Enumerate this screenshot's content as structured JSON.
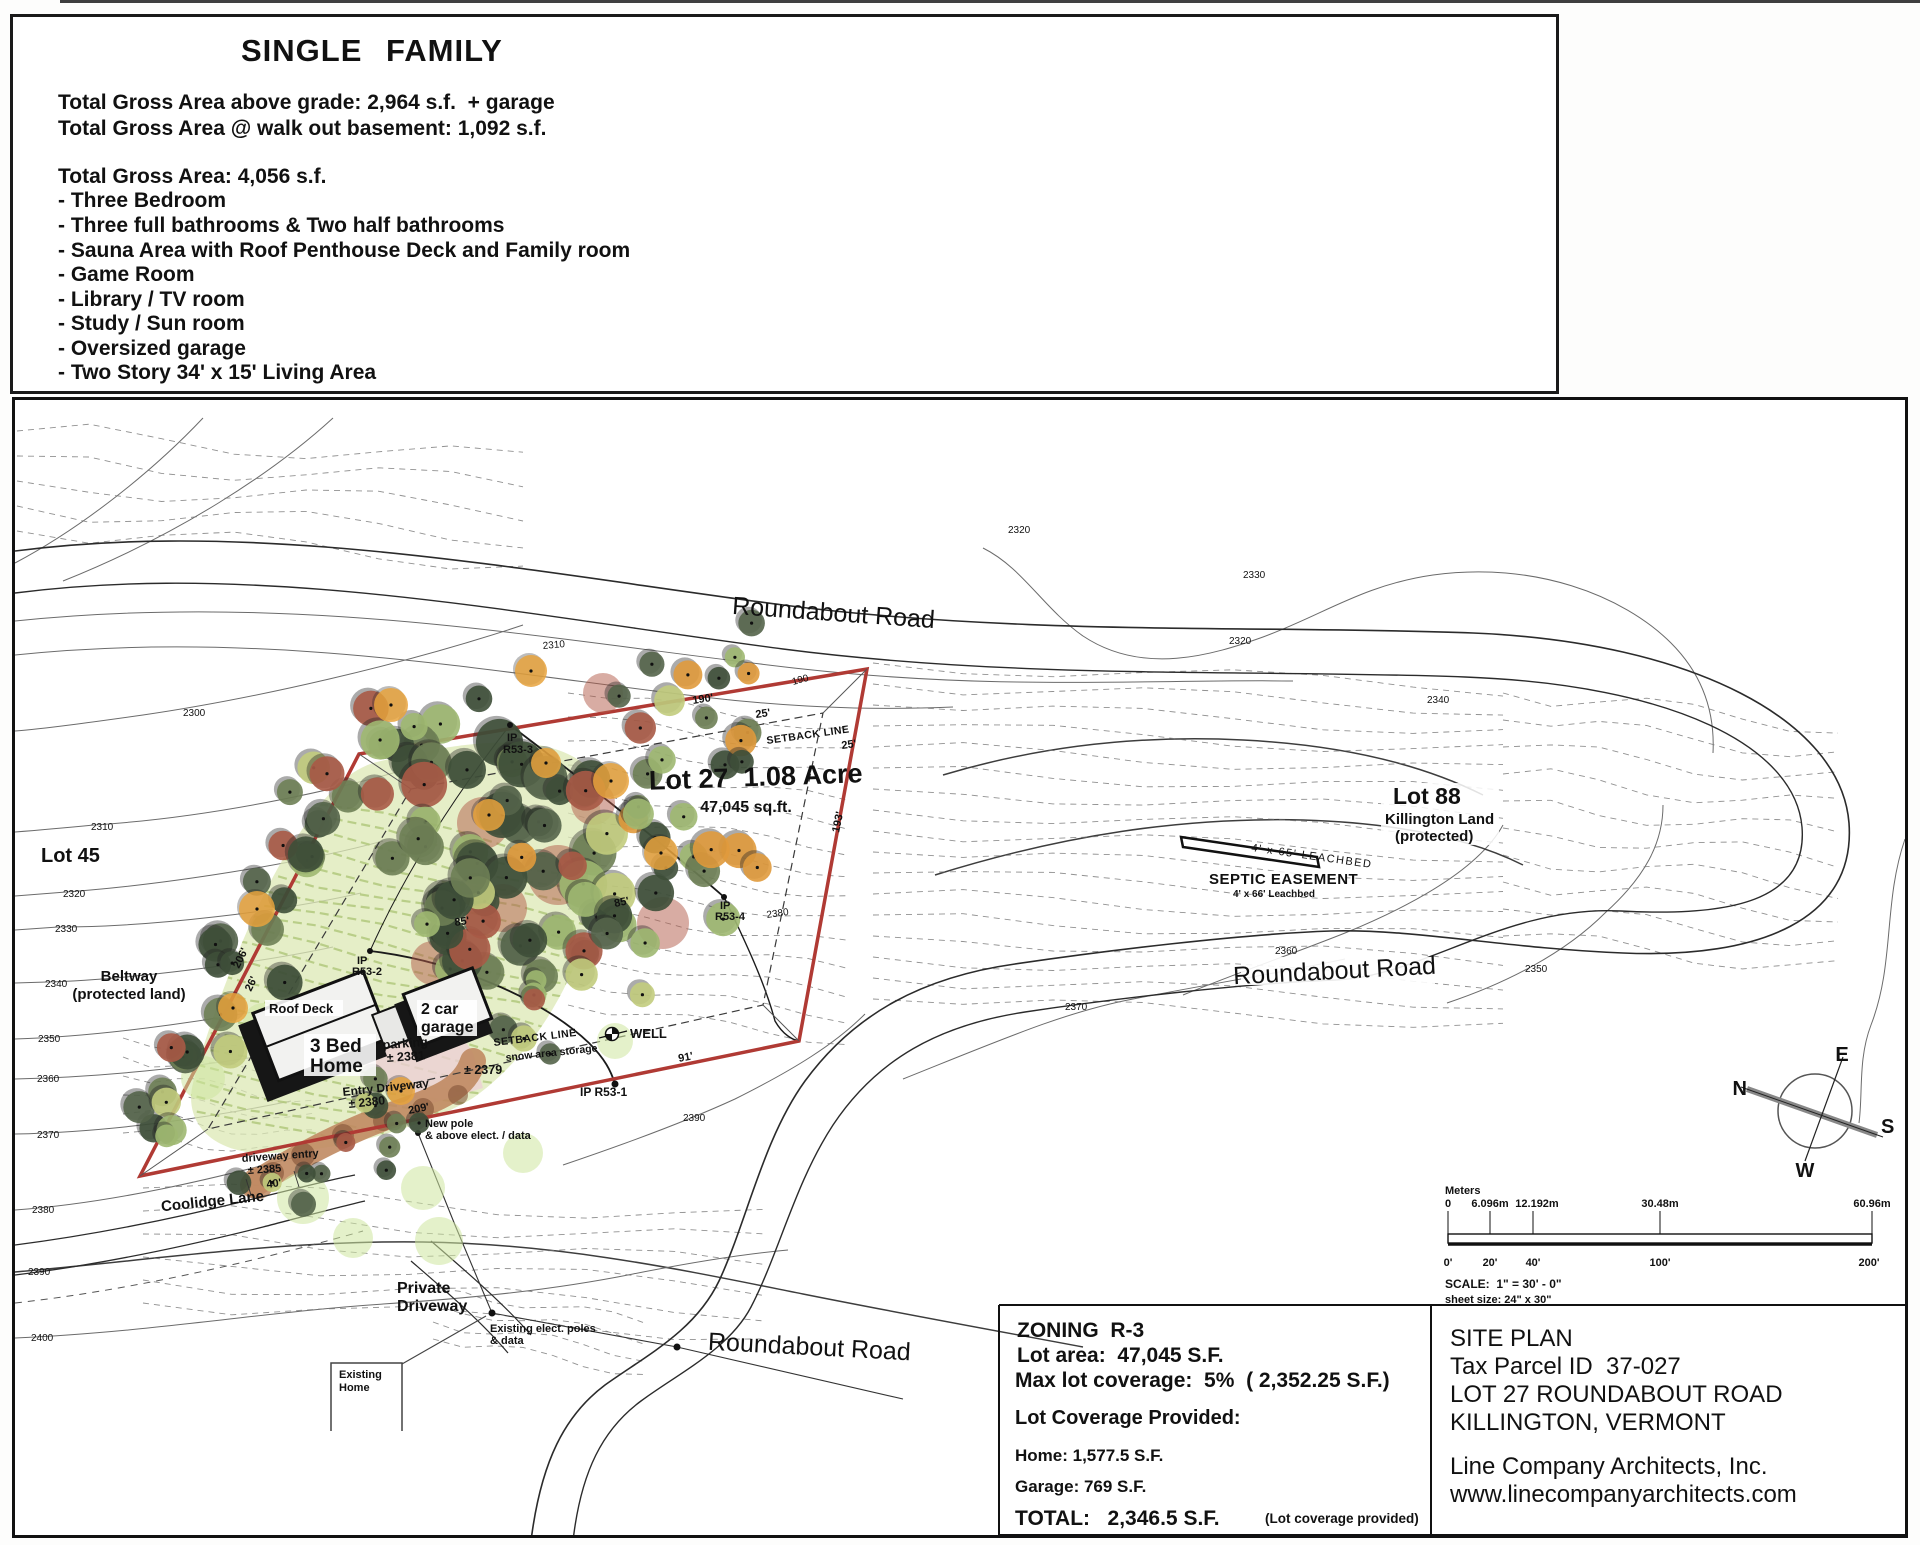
{
  "header": {
    "title": "SINGLE  FAMILY",
    "g1": [
      "Total Gross Area above grade: 2,964 s.f.  + garage",
      "Total Gross Area @ walk out basement: 1,092 s.f."
    ],
    "g2": [
      "Total Gross Area: 4,056 s.f.",
      "- Three Bedroom",
      "- Three full bathrooms & Two half bathrooms",
      "- Sauna Area with Roof Penthouse Deck and Family room",
      "- Game Room",
      "- Library / TV room",
      "- Study / Sun room",
      "- Oversized garage",
      "- Two Story 34' x 15' Living Area"
    ]
  },
  "map": {
    "roads": {
      "top": "Roundabout Road",
      "mid": "Roundabout Road",
      "bottom": "Roundabout Road",
      "coolidge": "Coolidge Lane",
      "private1": "Private",
      "private2": "Driveway"
    },
    "lots": {
      "lot27": "Lot 27  1.08 Acre",
      "lot27_area": "47,045 sq.ft.",
      "lot88": "Lot 88",
      "lot88_sub1": "Killington Land",
      "lot88_sub2": "(protected)",
      "lot45": "Lot 45",
      "beltway1": "Beltway",
      "beltway2": "(protected land)"
    },
    "septic": {
      "title": "SEPTIC EASEMENT",
      "sub": "4' x 66' Leachbed",
      "hand": "4' x 65' LEACHBED"
    },
    "bldg": {
      "roof_deck": "Roof Deck",
      "home1": "3 Bed",
      "home2": "Home",
      "garage1": "2 car",
      "garage2": "garage",
      "exist1": "Existing",
      "exist2": "Home"
    },
    "notes": {
      "parking1": "parking",
      "parking2": "± 2381",
      "e2379": "± 2379",
      "entry1": "Entry Driveway",
      "entry2": "± 2380",
      "pole1": "New pole",
      "pole2": "& above elect. / data",
      "drv1": "driveway entry",
      "drv2": "± 2385",
      "poles1": "Existing elect. poles",
      "poles2": "& data",
      "snow": "snow area storage",
      "setback": "SETBACK LINE",
      "well": "WELL"
    },
    "pins": {
      "ip1": "IP R53-1",
      "ip": "IP",
      "r2": "R53-2",
      "r3": "R53-3",
      "r4": "R53-4"
    },
    "dims": {
      "d190": "190'",
      "d190p": "190",
      "d193": "193'",
      "d206": "206'",
      "d209": "209'",
      "d91": "91'",
      "d85": "85'",
      "d26": "26'",
      "d40": "40'",
      "d25": "25'"
    },
    "contours": {
      "c2300": "2300",
      "c2310": "2310",
      "c2320": "2320",
      "c2330": "2330",
      "c2340": "2340",
      "c2350": "2350",
      "c2360": "2360",
      "c2370": "2370",
      "c2380": "2380",
      "c2390": "2390",
      "c2400": "2400"
    },
    "compass": {
      "n": "N",
      "e": "E",
      "s": "S",
      "w": "W"
    },
    "scalebar": {
      "meters": "Meters",
      "m": [
        "0",
        "6.096m",
        "12.192m",
        "30.48m",
        "60.96m"
      ],
      "f": [
        "0'",
        "20'",
        "40'",
        "100'",
        "200'"
      ],
      "scale": "SCALE:  1\" = 30' - 0\"",
      "sheet": "sheet size: 24\" x 30\""
    },
    "zoning": {
      "l1": "ZONING  R-3",
      "l2": "Lot area:  47,045 S.F.",
      "l3": "Max lot coverage:  5%  ( 2,352.25 S.F.)",
      "l4": "Lot Coverage Provided:",
      "l5": "Home: 1,577.5 S.F.",
      "l6": "Garage: 769 S.F.",
      "l7": "TOTAL:   2,346.5 S.F.",
      "note": "(Lot coverage provided)"
    },
    "titleblock": {
      "l1": "SITE PLAN",
      "l2": "Tax Parcel ID  37-027",
      "l3": "LOT 27 ROUNDABOUT ROAD",
      "l4": "KILLINGTON, VERMONT",
      "l5": "Line Company Architects, Inc.",
      "l6": "www.linecompanyarchitects.com"
    }
  },
  "colors": {
    "boundary_red": "#b03a34",
    "driveway_tan": "#c08a62",
    "meadow_green": "#dce8b4",
    "tree_dark": "#3e4f38",
    "tree_orange": "#e09a3c",
    "parking_pink": "#ecd0d4"
  }
}
